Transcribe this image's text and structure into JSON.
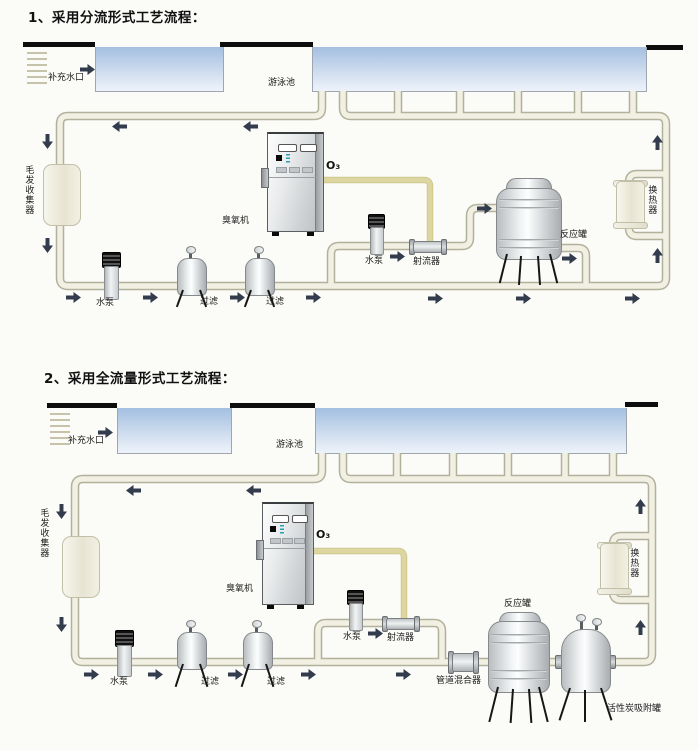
{
  "colors": {
    "page_bg": "#fbfbf8",
    "deck": "#0d0d0d",
    "water_top": "#a3bfe1",
    "water_mid": "#cedcee",
    "water_bottom": "#eef3fa",
    "pipe_edge": "#b2b19b",
    "pipe_fill": "#f1f0e3",
    "ozone_line": "#ddd6a0",
    "arrow": "#333c4c"
  },
  "icons": {
    "flow_arrow": "solid block arrow (css clip-path triangle with stem)",
    "pool_water": "blue gradient rectangle",
    "inlet_grate": "stacked horizontal slats"
  },
  "d1": {
    "title": "1、采用分流形式工艺流程：",
    "labels": {
      "makeup_inlet": "补充水口",
      "pool": "游泳池",
      "hair_collector": "毛发收集器",
      "pump": "水泵",
      "filter_a": "过滤",
      "filter_b": "过滤",
      "ozone_generator": "臭氧机",
      "ozone_gas": "O₃",
      "booster_pump": "水泵",
      "injector": "射流器",
      "reaction_tank": "反应罐",
      "heat_exchanger": "换热器"
    }
  },
  "d2": {
    "title": "2、采用全流量形式工艺流程：",
    "labels": {
      "makeup_inlet": "补充水口",
      "pool": "游泳池",
      "hair_collector": "毛发收集器",
      "pump": "水泵",
      "filter_a": "过滤",
      "filter_b": "过滤",
      "ozone_generator": "臭氧机",
      "ozone_gas": "O₃",
      "booster_pump": "水泵",
      "injector": "射流器",
      "pipe_mixer": "管道混合器",
      "reaction_tank": "反应罐",
      "carbon_tank": "活性炭吸附罐",
      "heat_exchanger": "换热器"
    }
  }
}
